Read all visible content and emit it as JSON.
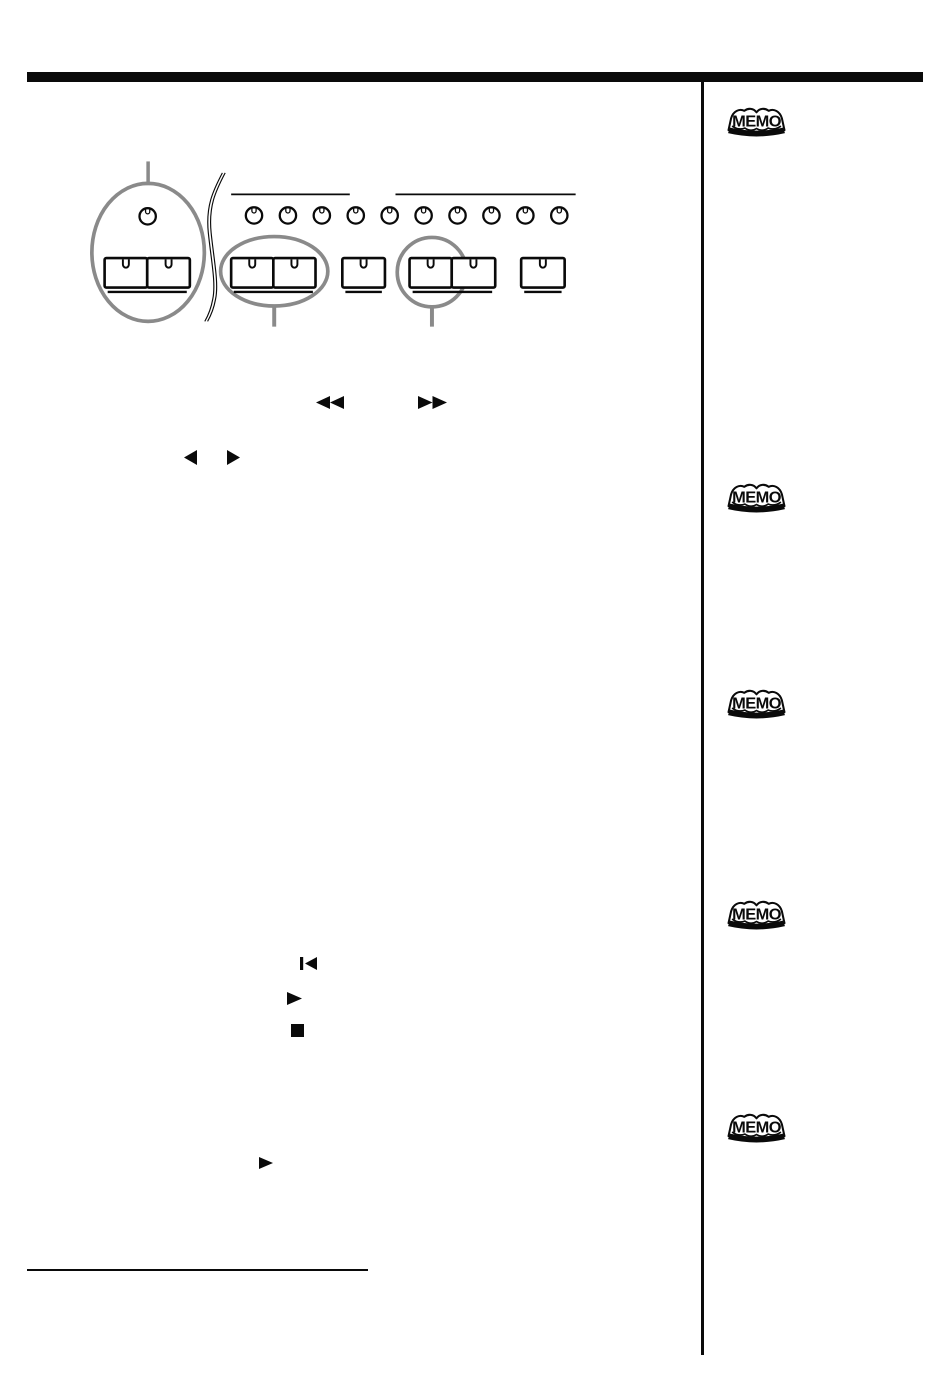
{
  "page": {
    "bg_color": "#ffffff",
    "ink_color": "#0a0a0a",
    "annotation_color": "#8a8a8a"
  },
  "sidebar": {
    "memo_badges": [
      {
        "label": "MEMO"
      },
      {
        "label": "MEMO"
      },
      {
        "label": "MEMO"
      },
      {
        "label": "MEMO"
      },
      {
        "label": "MEMO"
      }
    ]
  },
  "diagram": {
    "left_knob_count": 1,
    "right_knob_count": 10,
    "button_groups": [
      {
        "type": "pair",
        "callout": "large-ellipse-with-knob"
      },
      {
        "type": "pair",
        "callout": "ellipse"
      },
      {
        "type": "single",
        "callout": "none"
      },
      {
        "type": "pair",
        "callout": "circle-on-first-button"
      },
      {
        "type": "single",
        "callout": "none"
      }
    ]
  },
  "symbols": [
    {
      "name": "rewind-icon",
      "glyph": "◄◄"
    },
    {
      "name": "fast-forward-icon",
      "glyph": "►►"
    },
    {
      "name": "cursor-left-icon",
      "glyph": "◄"
    },
    {
      "name": "cursor-right-icon",
      "glyph": "►"
    },
    {
      "name": "skip-to-start-icon",
      "glyph": "|◄"
    },
    {
      "name": "play-icon",
      "glyph": "►"
    },
    {
      "name": "stop-icon",
      "glyph": "■"
    },
    {
      "name": "play-icon-2",
      "glyph": "►"
    }
  ]
}
